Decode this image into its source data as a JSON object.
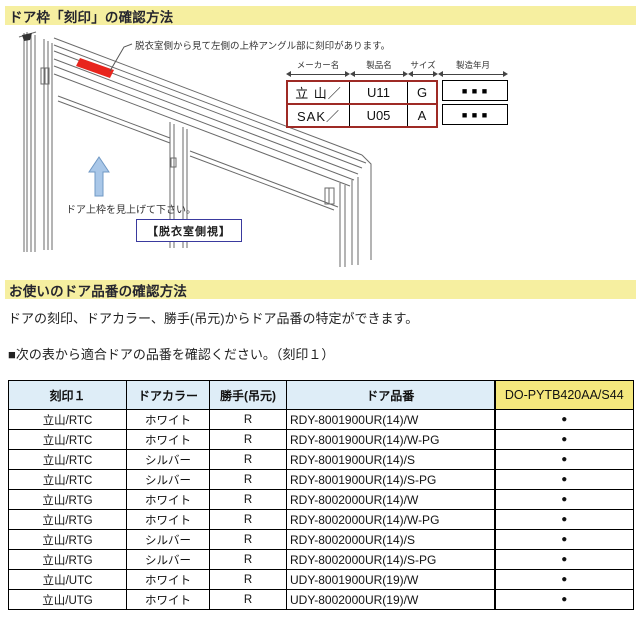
{
  "section1": {
    "title": "ドア枠「刻印」の確認方法"
  },
  "diagram": {
    "annotation": "脱衣室側から見て左側の上枠アングル部に刻印があります。",
    "look_up_note": "ドア上枠を見上げて下さい。",
    "view_label": "【脱衣室側視】",
    "stamp_table": {
      "col_headers": [
        "メーカー名",
        "製品名",
        "サイズ",
        "製造年月"
      ],
      "rows": [
        {
          "maker": "立 山／",
          "product": "U11",
          "size": "G",
          "date": "■ ■ ■"
        },
        {
          "maker": "SAK／",
          "product": "U05",
          "size": "A",
          "date": "■ ■ ■"
        }
      ]
    }
  },
  "section2": {
    "title": "お使いのドア品番の確認方法",
    "intro": "ドアの刻印、ドアカラー、勝手(吊元)からドア品番の特定ができます。",
    "instruction": "■次の表から適合ドアの品番を確認ください。（刻印１）"
  },
  "door_table": {
    "headers": [
      "刻印１",
      "ドアカラー",
      "勝手(吊元)",
      "ドア品番",
      "DO-PYTB420AA/S44"
    ],
    "col_widths": [
      118,
      83,
      77,
      208,
      139
    ],
    "rows": [
      [
        "立山/RTC",
        "ホワイト",
        "R",
        "RDY-8001900UR(14)/W",
        "●"
      ],
      [
        "立山/RTC",
        "ホワイト",
        "R",
        "RDY-8001900UR(14)/W-PG",
        "●"
      ],
      [
        "立山/RTC",
        "シルバー",
        "R",
        "RDY-8001900UR(14)/S",
        "●"
      ],
      [
        "立山/RTC",
        "シルバー",
        "R",
        "RDY-8001900UR(14)/S-PG",
        "●"
      ],
      [
        "立山/RTG",
        "ホワイト",
        "R",
        "RDY-8002000UR(14)/W",
        "●"
      ],
      [
        "立山/RTG",
        "ホワイト",
        "R",
        "RDY-8002000UR(14)/W-PG",
        "●"
      ],
      [
        "立山/RTG",
        "シルバー",
        "R",
        "RDY-8002000UR(14)/S",
        "●"
      ],
      [
        "立山/RTG",
        "シルバー",
        "R",
        "RDY-8002000UR(14)/S-PG",
        "●"
      ],
      [
        "立山/UTC",
        "ホワイト",
        "R",
        "UDY-8001900UR(19)/W",
        "●"
      ],
      [
        "立山/UTG",
        "ホワイト",
        "R",
        "UDY-8002000UR(19)/W",
        "●"
      ]
    ]
  },
  "colors": {
    "section_bar": "#F6EFA0",
    "section_title": "#26262E",
    "table_header_blue": "#DEEDF7",
    "table_header_yellow": "#F5E87D",
    "stamp_mark_red": "#E8251D",
    "stamp_border_red": "#9E2A25",
    "arrow_blue": "#A9C7E8",
    "view_label_border": "#3A3A9E"
  }
}
